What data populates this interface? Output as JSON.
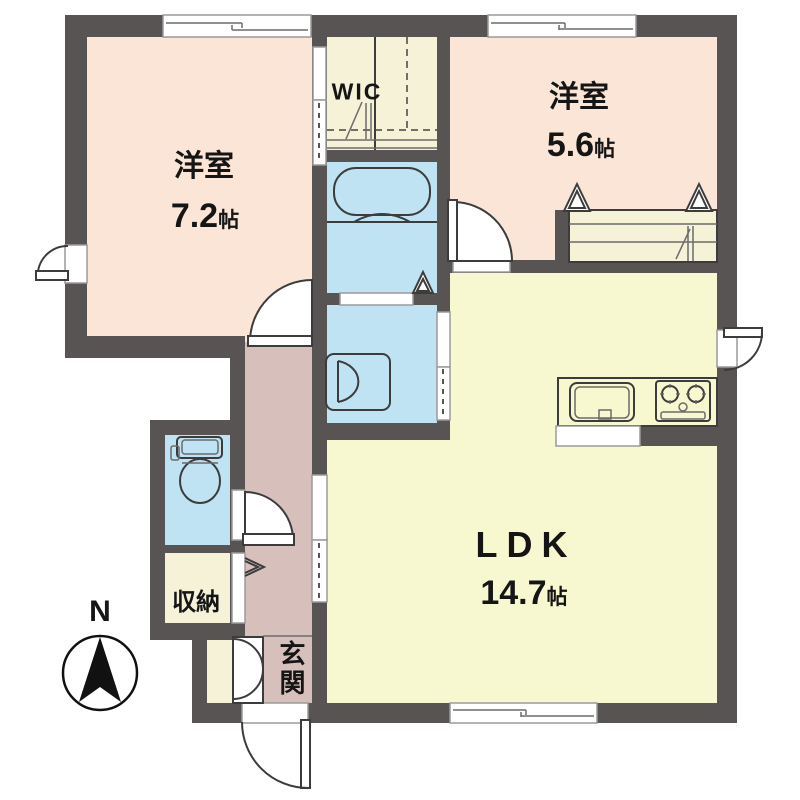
{
  "colors": {
    "wall": "#595454",
    "bedroom": "#fbe5d7",
    "ldk": "#f8f8d0",
    "hall": "#d7c0bb",
    "wet_area": "#c0e3f4",
    "closet": "#f5f2d8",
    "door_white": "#ffffff",
    "line": "#3c3c3c"
  },
  "rooms": {
    "bedroom1": {
      "name": "洋室",
      "size": "7.2",
      "unit": "帖"
    },
    "bedroom2": {
      "name": "洋室",
      "size": "5.6",
      "unit": "帖"
    },
    "ldk": {
      "name": "LDK",
      "size": "14.7",
      "unit": "帖"
    },
    "wic": {
      "name": "WIC"
    },
    "storage": {
      "name": "収納"
    },
    "entrance": {
      "name": "玄関"
    }
  },
  "compass": {
    "north": "N"
  },
  "fixtures": [
    "bathtub",
    "washbasin",
    "toilet",
    "kitchen-sink",
    "gas-stove",
    "north-compass"
  ]
}
